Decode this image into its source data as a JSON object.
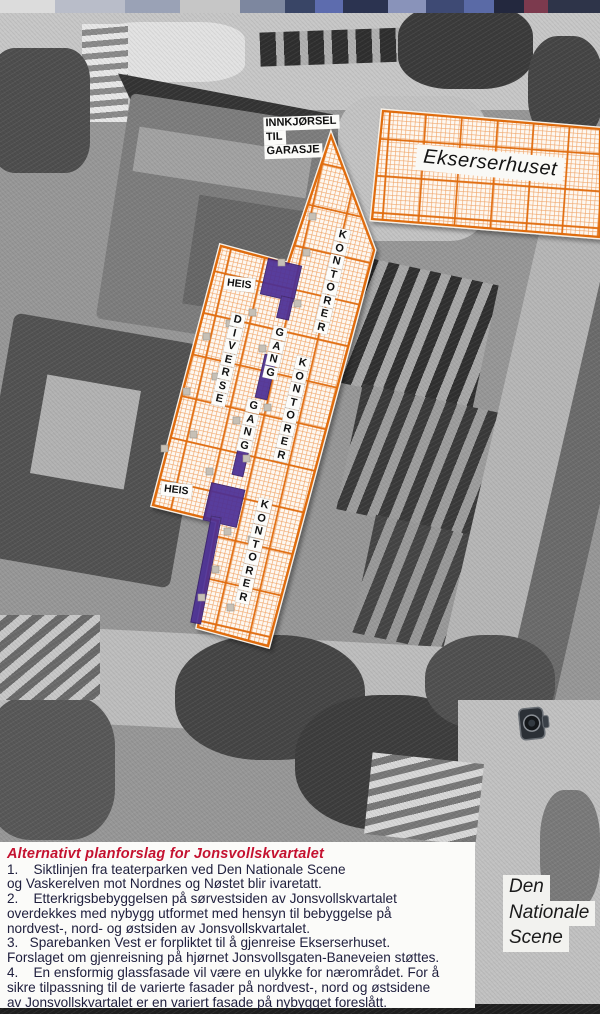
{
  "plan": {
    "garage_label_lines": [
      "INNKJØRSEL",
      "TIL",
      "GARASJE"
    ],
    "ekserserhuset_label": "Ekserserhuset",
    "heis_labels": [
      "HEIS",
      "HEIS"
    ],
    "diverse_label": "DIVERSE",
    "gang_labels": [
      "GANG",
      "GANG"
    ],
    "kontorer_labels": [
      "KONTORER",
      "KONTORER",
      "KONTORER"
    ],
    "scene_label_lines": [
      "Den",
      "Nationale",
      "Scene"
    ]
  },
  "notes": {
    "heading": "Alternativt planforslag for Jonsvollskvartalet",
    "lines": [
      "1.    Siktlinjen fra teaterparken ved Den Nationale Scene",
      "og Vaskerelven mot Nordnes og Nøstet blir ivaretatt.",
      "2.    Etterkrigsbebyggelsen på sørvestsiden av Jonsvollskvartalet",
      "overdekkes med nybygg utformet med hensyn til bebyggelse på",
      "nordvest-, nord- og østsiden av Jonsvollskvartalet.",
      "3.   Sparebanken Vest er forpliktet til å gjenreise Ekserserhuset.",
      "Forslaget om gjenreisning på hjørnet Jonsvollsgaten-Baneveien støttes.",
      "4.    En ensformig glassfasade vil være en ulykke for nærområdet. For å",
      "sikre tilpassning til de varierte fasader på nordvest-, nord og østsidene",
      "av Jonsvollskvartalet er en variert fasade på nybygget foreslått."
    ]
  },
  "colors": {
    "hatch_coarse_orange": "#e06c10",
    "hatch_fine_orange": "#f0a468",
    "corridor_purple": "#4c2f95",
    "heading_red": "#c41230",
    "body_ink": "#20203e"
  }
}
